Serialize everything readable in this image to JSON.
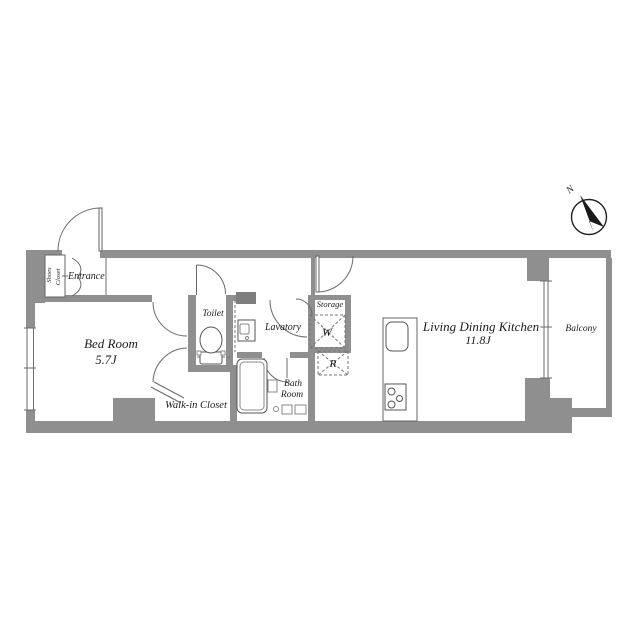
{
  "labels": {
    "shoes_closet_line1": "Shoes",
    "shoes_closet_line2": "Closet",
    "entrance": "Entrance",
    "bed_room": "Bed Room",
    "bed_room_size": "5.7J",
    "toilet": "Toilet",
    "lavatory": "Lavatory",
    "storage": "Storage",
    "washer": "W",
    "refrigerator": "R",
    "bath_room_line1": "Bath",
    "bath_room_line2": "Room",
    "walk_in_closet": "Walk-in Closet",
    "living_dining_kitchen": "Living Dining Kitchen",
    "living_dining_kitchen_size": "11.8J",
    "balcony": "Balcony",
    "compass_north": "N"
  },
  "colors": {
    "wall": "#8f8f8f",
    "shaft": "#7e7e7e",
    "line": "#555555",
    "text": "#1c1c1c",
    "background": "#ffffff"
  }
}
